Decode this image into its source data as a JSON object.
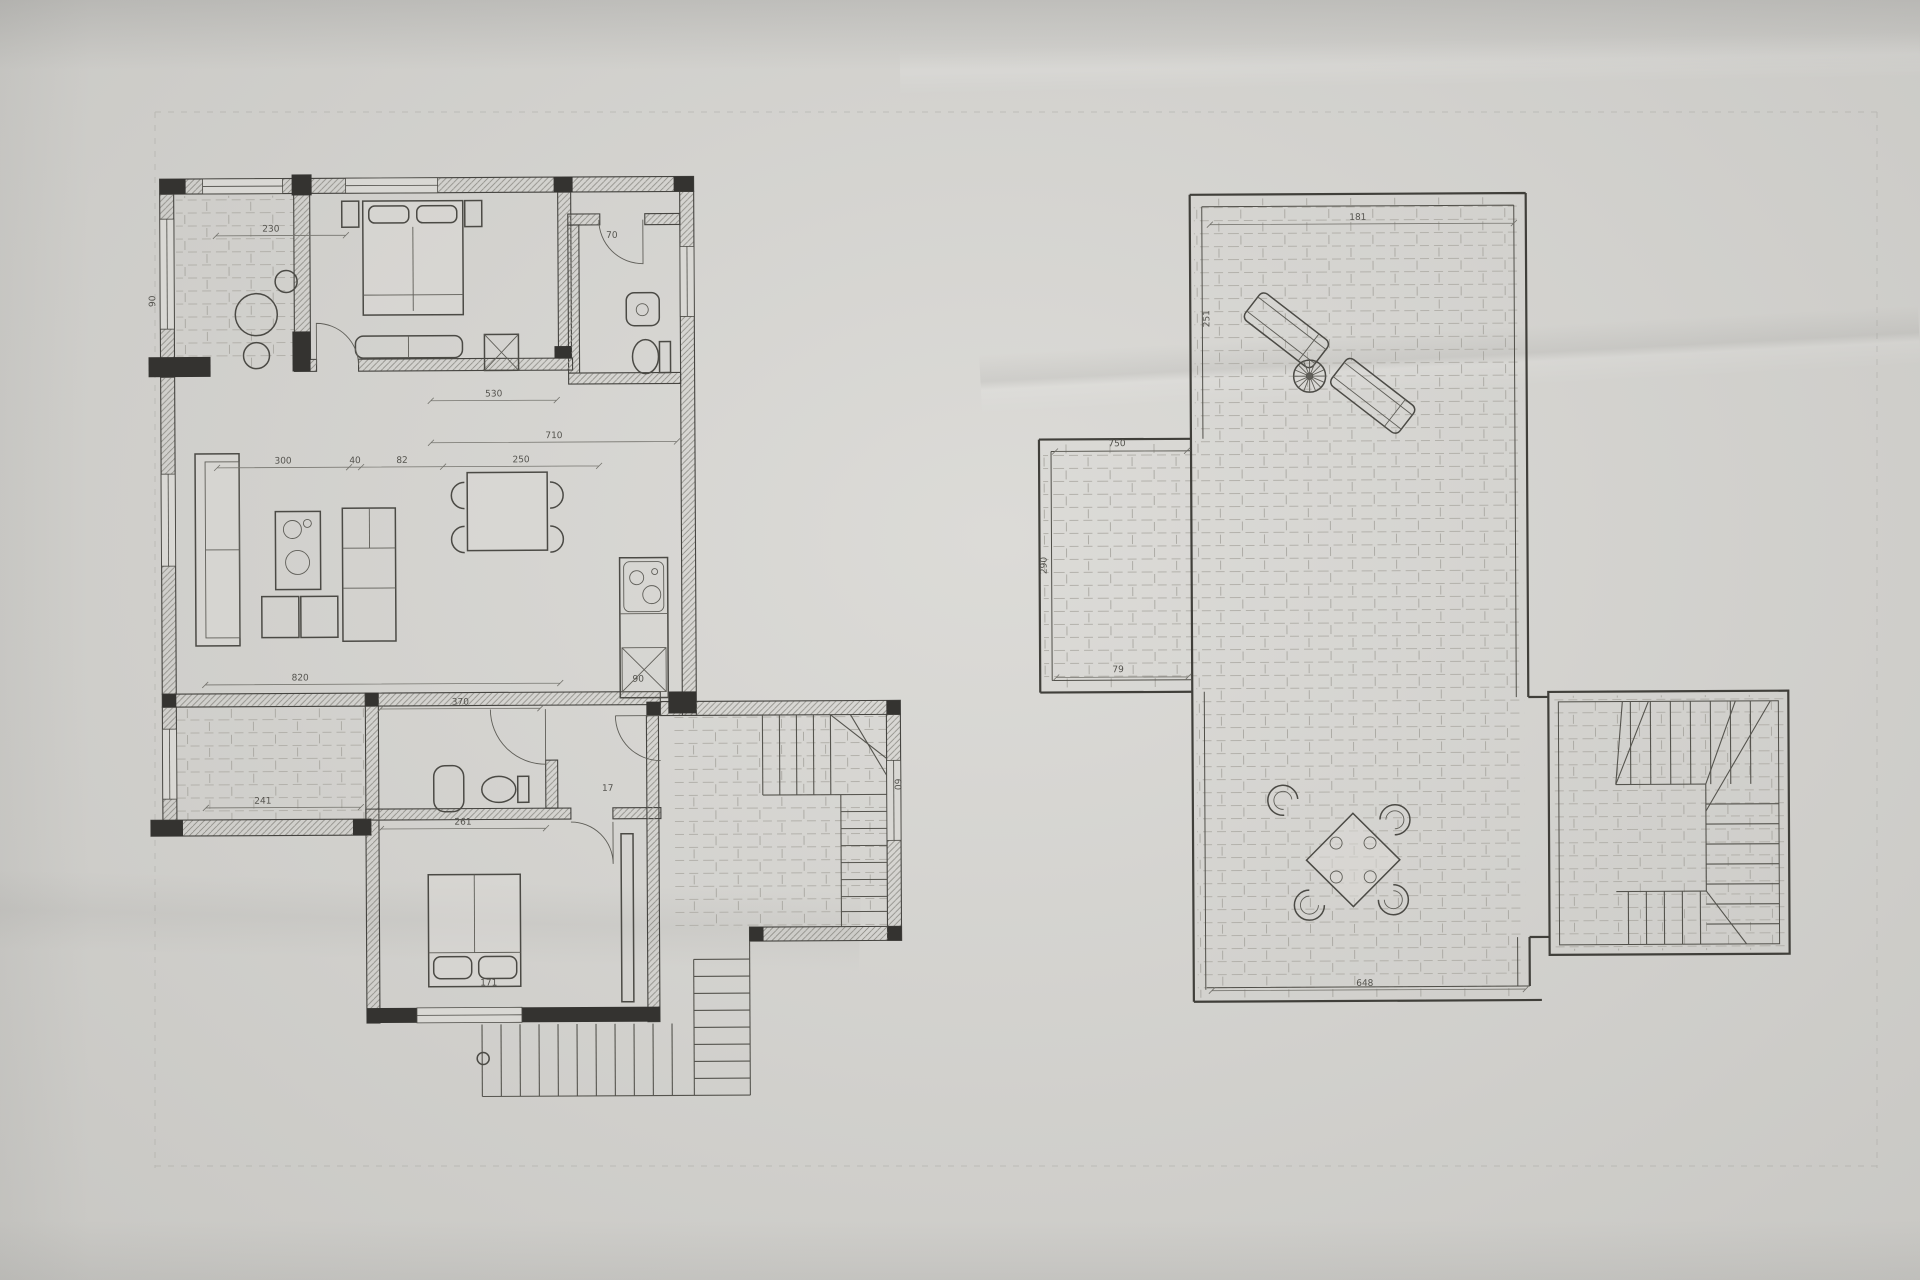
{
  "sheet": {
    "description": "scanned hand-drafted architectural floor plan, two plans on one sheet",
    "paper_color": "#d8d7d3",
    "ink_color": "#3f3e39",
    "hatch_color": "#b3b1ab"
  },
  "symbols": {
    "round-table-icon": "circle table, plan symbol",
    "bed-icon": "double bed with pillows",
    "bedside-table-icon": "small square table",
    "wardrobe-icon": "long divided cabinet",
    "sofa-icon": "sofa with back and cushions",
    "stove-icon": "cabinet with two round plates",
    "coffee-table-icon": "pair of square tables",
    "tv-cabinet-icon": "shelved sideboard",
    "dining-table-icon": "square table with four chairs",
    "kitchen-counter-icon": "counter with sink bowls and oven cross",
    "washbasin-icon": "rounded basin",
    "toilet-icon": "WC pan with cistern",
    "shaft-icon": "crossed duct box",
    "door-arc-icon": "door leaf with quarter-circle swing",
    "stair-icon": "stair flight with treads and winders",
    "sun-lounger-icon": "slatted lounger",
    "parasol-icon": "round parasol with spokes",
    "patio-chair-icon": "C-shaped round chair"
  },
  "left_plan": {
    "dims": {
      "terrace_top": "230",
      "bath_door": "70",
      "bed_width": "530",
      "bedroom_width": "710",
      "living_a": "300",
      "living_b": "40",
      "living_c": "82",
      "dining_width": "250",
      "left_wall_v": "90",
      "living_width": "820",
      "bath2_width": "370",
      "terrace2_width": "241",
      "bed2_wall": "261",
      "bed2_width": "171",
      "stair_risers": "17",
      "hall_width": "90",
      "landing_side_v": "60"
    }
  },
  "right_plan": {
    "dims": {
      "top_width": "181",
      "ext_top": "750",
      "ext_bottom": "79",
      "ext_side_v": "290",
      "side_v": "251",
      "bottom_width": "648"
    }
  }
}
